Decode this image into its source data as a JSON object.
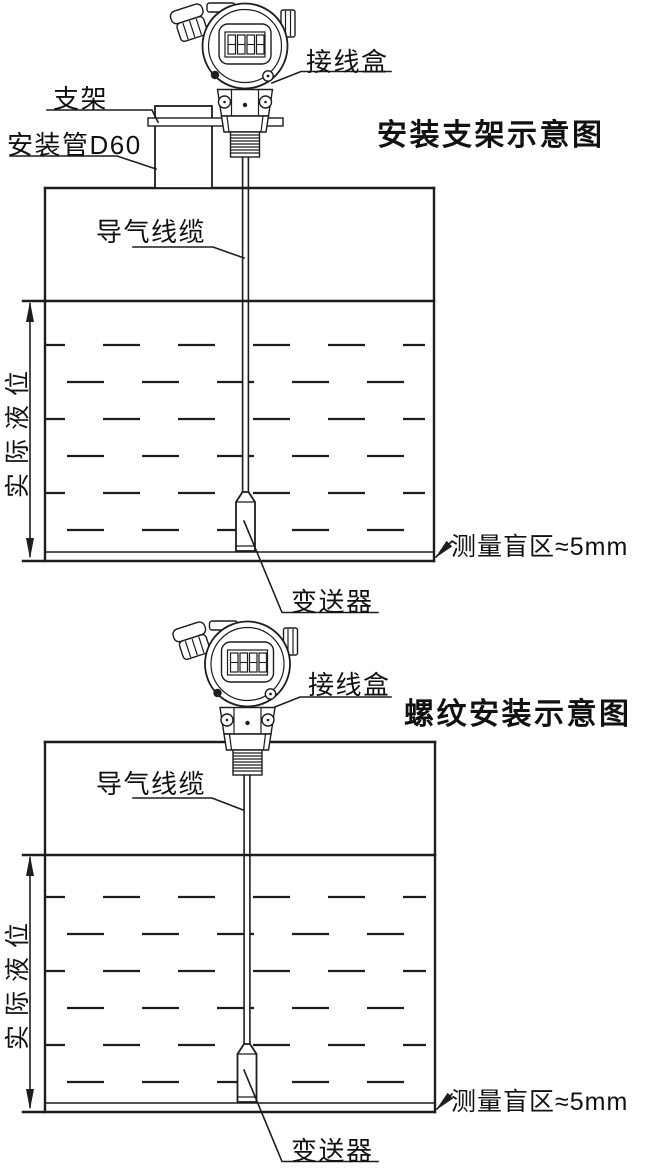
{
  "colors": {
    "line": "#1d1d1f",
    "text": "#111111",
    "background": "#ffffff"
  },
  "device": {
    "lcd_value": "8888"
  },
  "diagram_top": {
    "title": "安装支架示意图",
    "labels": {
      "junction_box": "接线盒",
      "bracket": "支架",
      "mounting_pipe": "安装管D60",
      "air_cable": "导气线缆",
      "actual_level": "实际液位",
      "blind_zone": "测量盲区≈5mm",
      "transmitter": "变送器"
    }
  },
  "diagram_bottom": {
    "title": "螺纹安装示意图",
    "labels": {
      "junction_box": "接线盒",
      "air_cable": "导气线缆",
      "actual_level": "实际液位",
      "blind_zone": "测量盲区≈5mm",
      "transmitter": "变送器"
    }
  }
}
